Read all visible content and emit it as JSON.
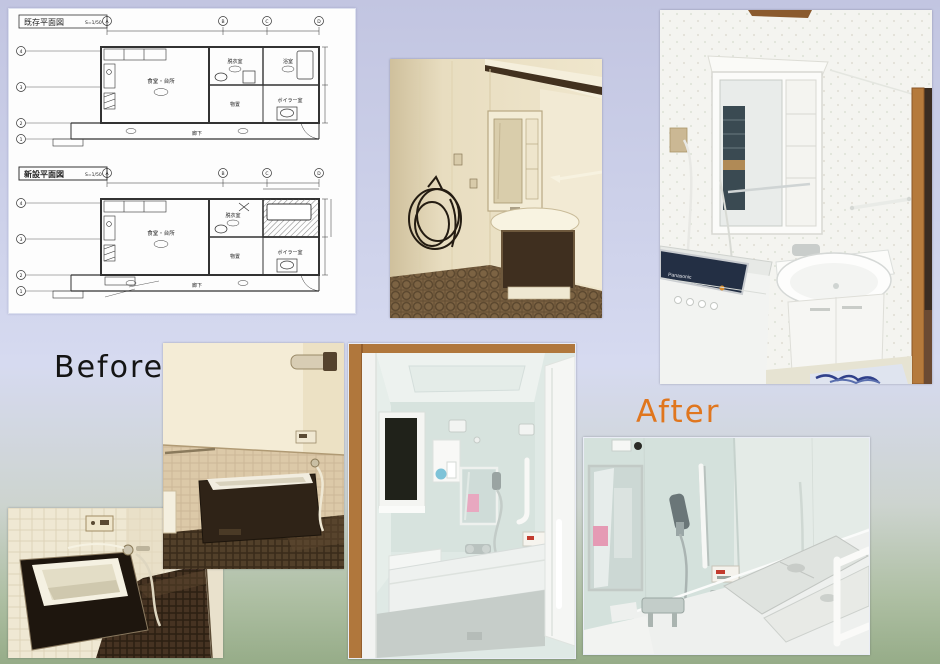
{
  "slide": {
    "bg_top": "#c2c5e1",
    "bg_mid": "#d6daf0",
    "bg_bottom": "#96ac88"
  },
  "labels": {
    "before": "Before",
    "before_color": "#141414",
    "after": "After",
    "after_color": "#e0761e"
  },
  "floor_plans": {
    "existing": {
      "title": "既存平面図",
      "scale": "S=1/50"
    },
    "new": {
      "title": "新設平面図",
      "scale": "S=1/50"
    },
    "rooms": {
      "dining_kitchen": "食堂・台所",
      "dressing_room": "脱衣室",
      "bathroom": "浴室",
      "storage": "物置",
      "boiler_room": "ボイラー室",
      "corridor": "廊下"
    },
    "grid_columns": [
      "A",
      "B",
      "C",
      "D"
    ],
    "grid_rows": [
      "4",
      "3",
      "2",
      "1"
    ]
  },
  "photos": {
    "after_washroom": {
      "washer_brand": "Panasonic"
    },
    "palette": {
      "sepia_wall": "#e9dec2",
      "sepia_dark": "#2f2317",
      "aqua_wall": "#d9e5e1",
      "wood_trim": "#b0773c"
    }
  }
}
